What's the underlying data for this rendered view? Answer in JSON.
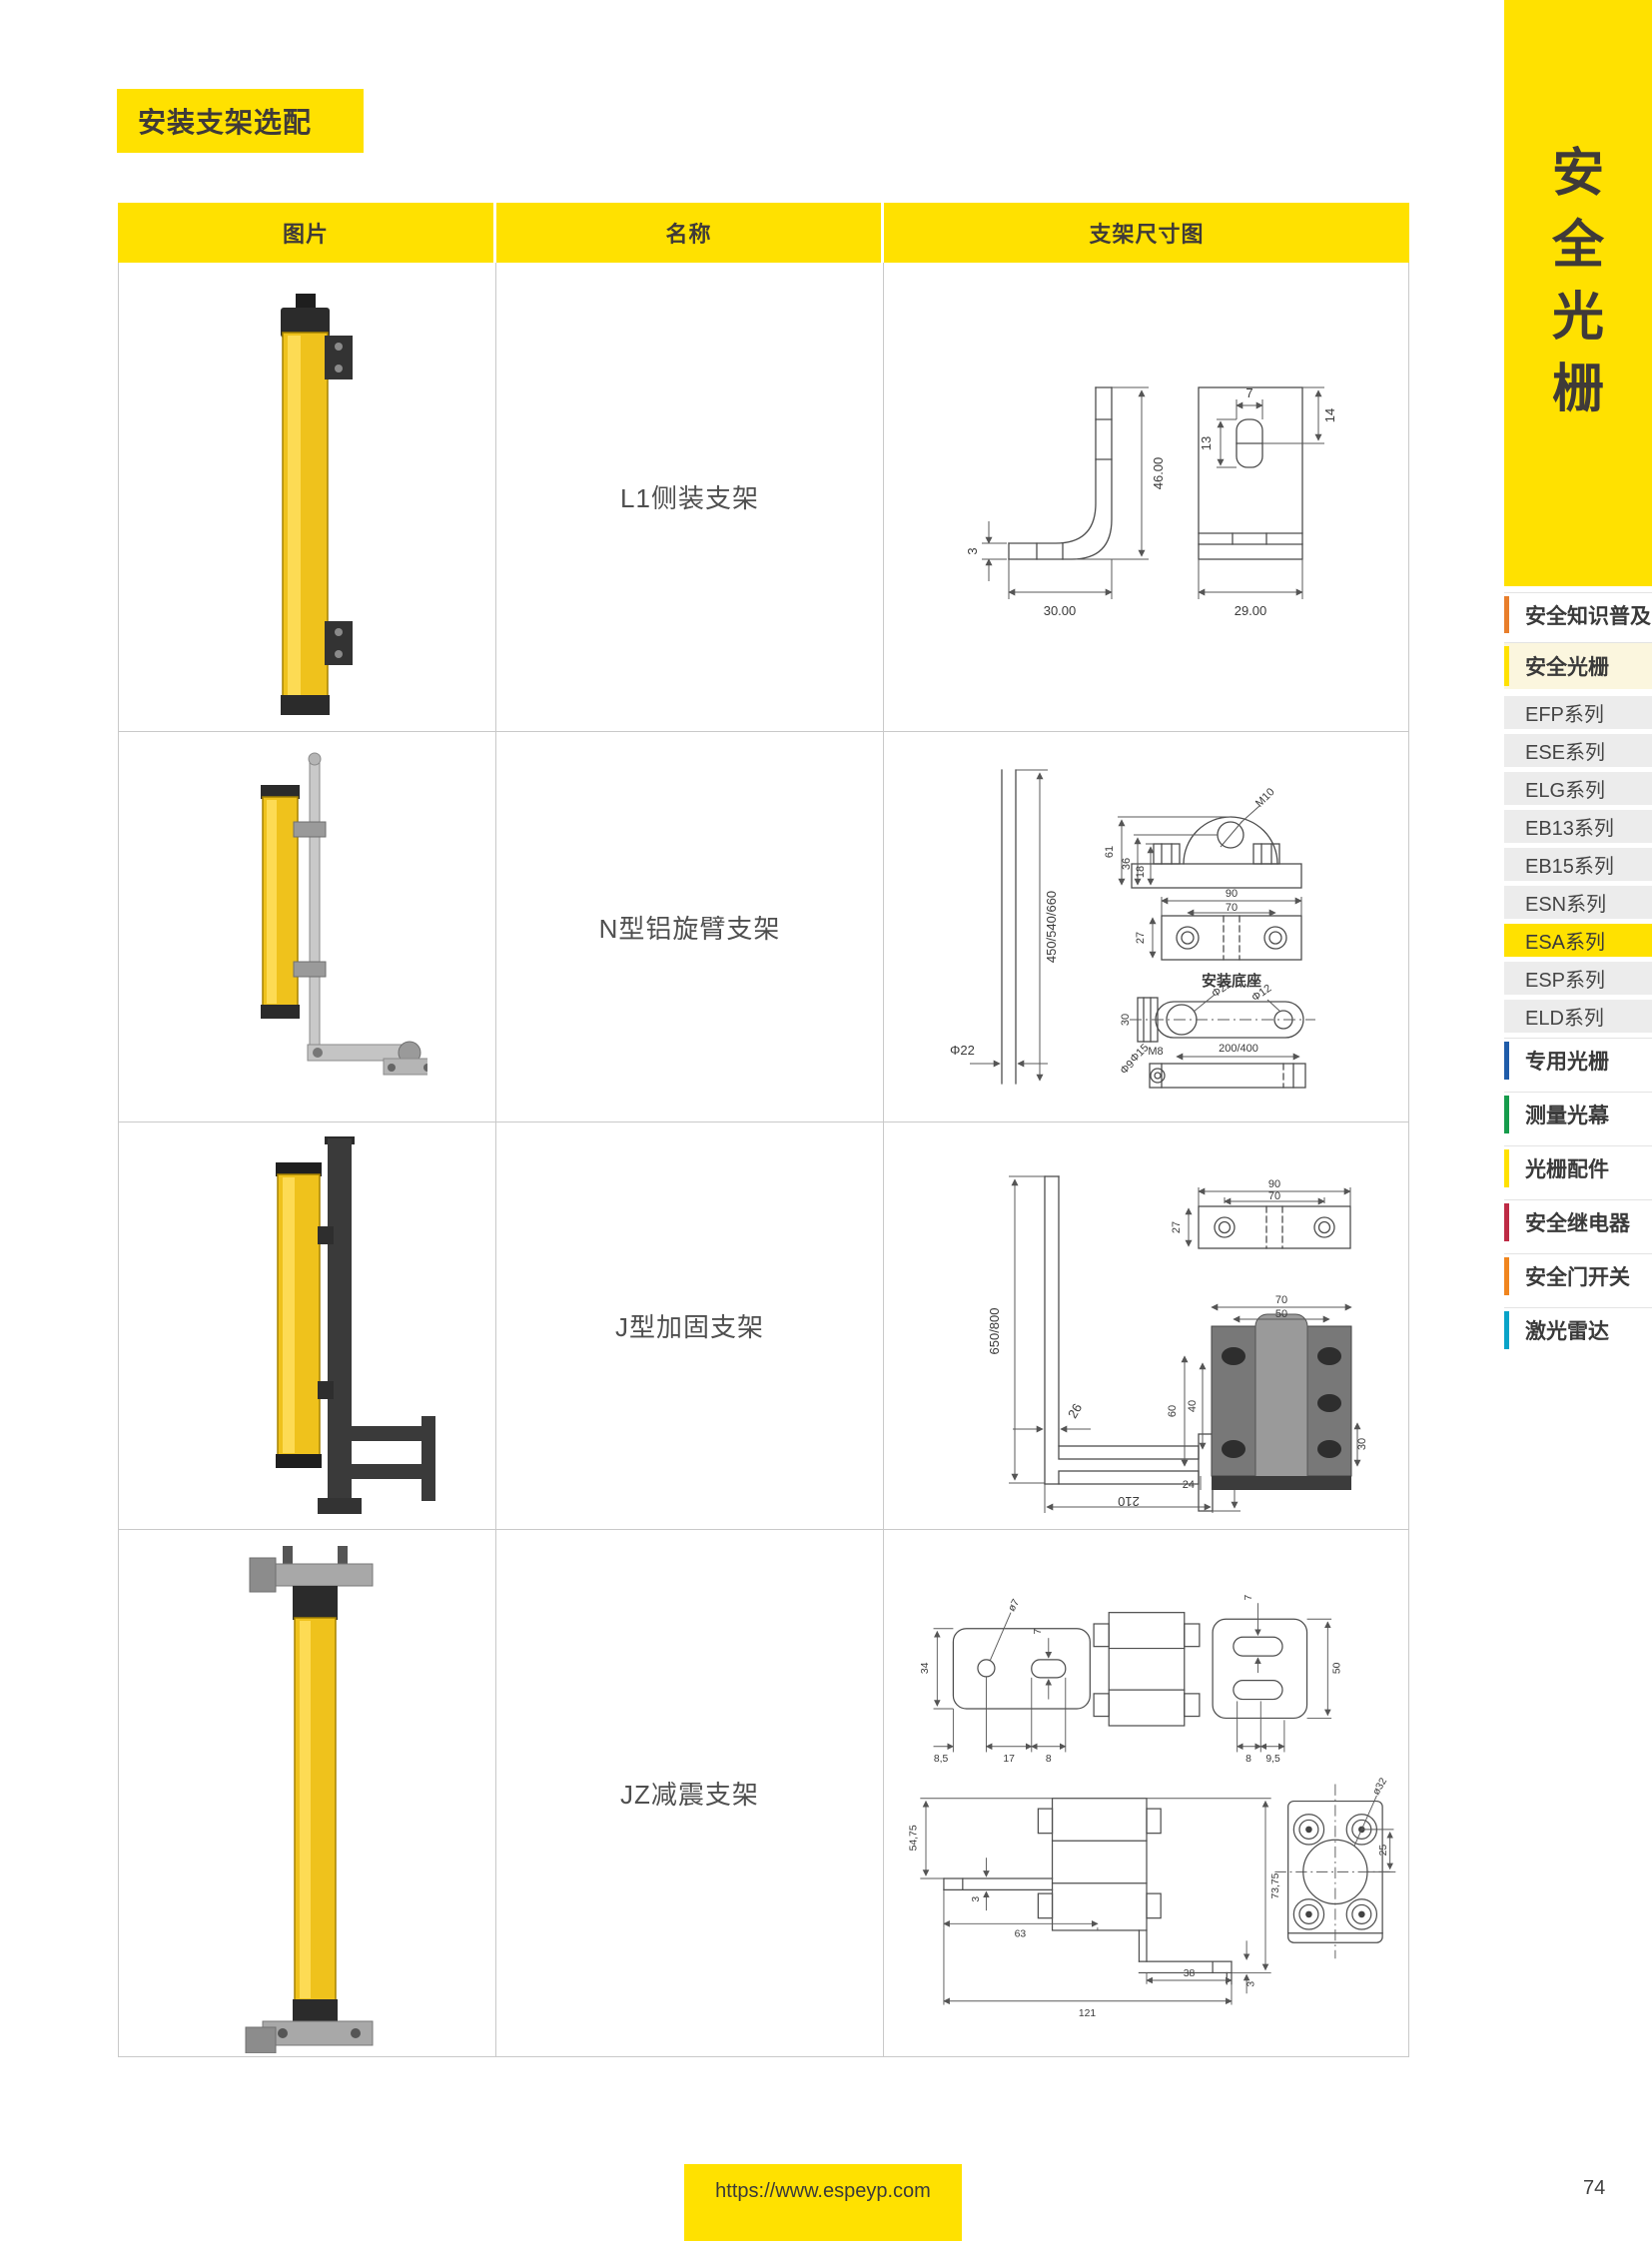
{
  "page": {
    "title_band": "安装支架选配",
    "footer_url": "https://www.espeyp.com",
    "page_number": "74"
  },
  "colors": {
    "accent_yellow": "#FFE100",
    "header_text": "#3F3A39",
    "series_item_bg": "#ECECEC",
    "active_series_bg": "#FFE100",
    "section_cream_bg": "#FBF6DE",
    "bar_orange": "#E87E2B",
    "bar_yellow": "#FFE100",
    "bar_blue": "#1F5CA9",
    "bar_green": "#169C4C",
    "bar_red": "#BE2B45",
    "bar_orange_dark": "#F0851E",
    "bar_cyan": "#09A3C8"
  },
  "table": {
    "headers": [
      "图片",
      "名称",
      "支架尺寸图"
    ],
    "rows": [
      {
        "name": "L1侧装支架",
        "dims": {
          "h": "46.00",
          "w": "30.00",
          "t": "3",
          "fw": "29.00",
          "sw": "7",
          "sh": "13",
          "st": "14"
        }
      },
      {
        "name": "N型铝旋臂支架",
        "dims": {
          "rod": "450/540/660",
          "rodd": "Φ22",
          "a1": "61",
          "a2": "36",
          "a3": "18",
          "a4": "M10",
          "p1": "90",
          "p2": "70",
          "p3": "27",
          "cap": "安装底座",
          "m1": "30",
          "m2": "M8",
          "m3": "Φ22",
          "m4": "Φ12",
          "b1": "200/400",
          "b2": "Φ15",
          "b3": "Φ9"
        }
      },
      {
        "name": "J型加固支架",
        "dims": {
          "h": "650/800",
          "g": "26",
          "f": "148",
          "b": "210",
          "p1": "90",
          "p2": "70",
          "p3": "27",
          "c1": "70",
          "c2": "50",
          "c3": "60",
          "c4": "40",
          "c5": "30",
          "c6": "24"
        }
      },
      {
        "name": "JZ减震支架",
        "dims": {
          "t1": "ø7",
          "t2": "7",
          "t3": "34",
          "t4": "7",
          "t5": "50",
          "t6": "8,5",
          "t7": "17",
          "t8": "8",
          "t9": "8",
          "t10": "9,5",
          "s1": "54,75",
          "s2": "3",
          "s3": "63",
          "s4": "121",
          "s5": "38",
          "s6": "3",
          "s7": "73,75",
          "f1": "ø32",
          "f2": "25"
        }
      }
    ]
  },
  "sidebar": {
    "vertical_title": "安全光栅",
    "title_chars": [
      "安",
      "全",
      "光",
      "栅"
    ],
    "items": [
      {
        "label": "安全知识普及"
      },
      {
        "label": "安全光栅"
      },
      {
        "label": "EFP系列"
      },
      {
        "label": "ESE系列"
      },
      {
        "label": "ELG系列"
      },
      {
        "label": "EB13系列"
      },
      {
        "label": "EB15系列"
      },
      {
        "label": "ESN系列"
      },
      {
        "label": "ESA系列",
        "active": true
      },
      {
        "label": "ESP系列"
      },
      {
        "label": "ELD系列"
      },
      {
        "label": "专用光栅"
      },
      {
        "label": "测量光幕"
      },
      {
        "label": "光栅配件"
      },
      {
        "label": "安全继电器"
      },
      {
        "label": "安全门开关"
      },
      {
        "label": "激光雷达"
      }
    ]
  }
}
